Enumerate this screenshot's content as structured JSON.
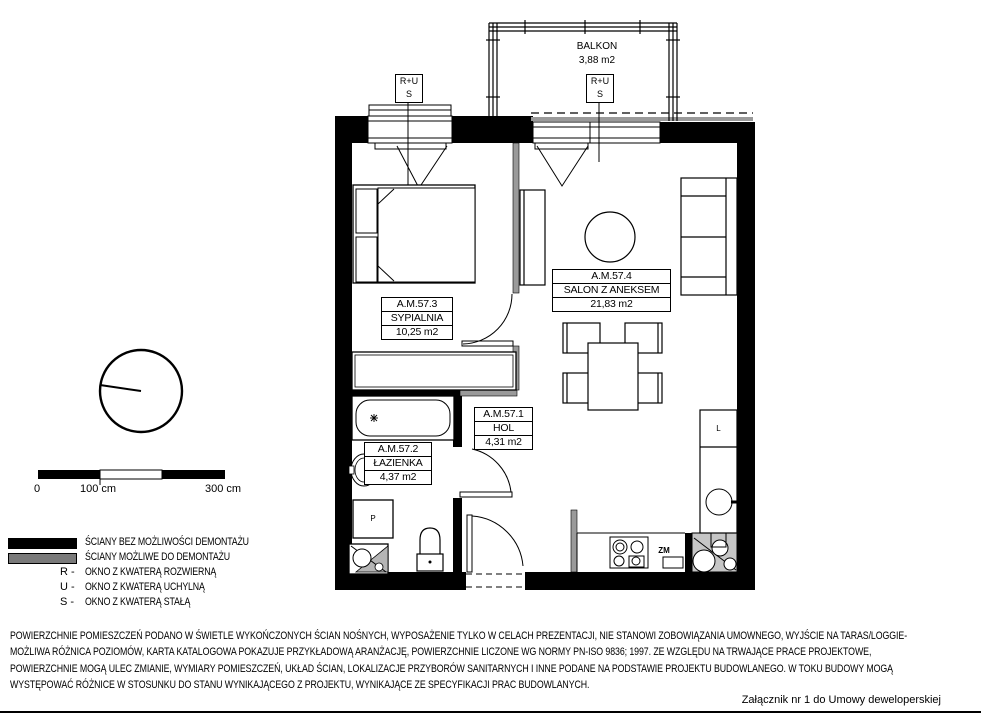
{
  "balcony": {
    "name": "BALKON",
    "area": "3,88 m2"
  },
  "window_tags": {
    "left": {
      "top": "R+U",
      "bottom": "S"
    },
    "right": {
      "top": "R+U",
      "bottom": "S"
    }
  },
  "rooms": {
    "bedroom": {
      "id": "A.M.57.3",
      "name": "SYPIALNIA",
      "area": "10,25 m2"
    },
    "living": {
      "id": "A.M.57.4",
      "name": "SALON Z ANEKSEM",
      "area": "21,83 m2"
    },
    "hall": {
      "id": "A.M.57.1",
      "name": "HOL",
      "area": "4,31 m2"
    },
    "bathroom": {
      "id": "A.M.57.2",
      "name": "ŁAZIENKA",
      "area": "4,37 m2"
    }
  },
  "fixtures": {
    "washing_machine": "P",
    "fridge": "L",
    "dishwasher": "ZM"
  },
  "scale_bar": {
    "zero": "0",
    "hundred": "100 cm",
    "three_hundred": "300 cm"
  },
  "legend": {
    "solid_walls": "ŚCIANY BEZ MOŻLIWOŚCI DEMONTAŻU",
    "removable_walls": "ŚCIANY MOŻLIWE DO DEMONTAŻU",
    "r_key": "R -",
    "r_text": "OKNO Z KWATERĄ ROZWIERNĄ",
    "u_key": "U -",
    "u_text": "OKNO Z KWATERĄ UCHYLNĄ",
    "s_key": "S -",
    "s_text": "OKNO Z KWATERĄ STAŁĄ"
  },
  "disclaimer": {
    "line1": "POWIERZCHNIE POMIESZCZEŃ PODANO W ŚWIETLE WYKOŃCZONYCH ŚCIAN NOŚNYCH, WYPOSAŻENIE TYLKO W CELACH PREZENTACJI, NIE STANOWI ZOBOWIĄZANIA UMOWNEGO, WYJŚCIE NA TARAS/LOGGIE-",
    "line2": "MOŻLIWA RÓŻNICA POZIOMÓW, KARTA KATALOGOWA POKAZUJE PRZYKŁADOWĄ ARANŻACJĘ, POWIERZCHNIE LICZONE WG NORMY PN-ISO 9836; 1997. ZE WZGLĘDU NA TRWAJĄCE PRACE PROJEKTOWE,",
    "line3": "POWIERZCHNIE MOGĄ ULEC ZMIANIE, WYMIARY POMIESZCZEŃ, UKŁAD ŚCIAN, LOKALIZACJE PRZYBORÓW SANITARNYCH I INNE PODANE NA PODSTAWIE PROJEKTU BUDOWLANEGO. W TOKU BUDOWY MOGĄ",
    "line4": "WYSTĘPOWAĆ RÓŻNICE W STOSUNKU DO STANU WYNIKAJĄCEGO Z PROJEKTU, WYNIKAJĄCE ZE SPECYFIKACJI PRAC BUDOWLANYCH."
  },
  "attachment_note": "Załącznik nr 1 do Umowy deweloperskiej",
  "colors": {
    "wall_solid": "#000000",
    "wall_removable": "#9a9a9a",
    "legend_removable": "#7a7a7a"
  }
}
